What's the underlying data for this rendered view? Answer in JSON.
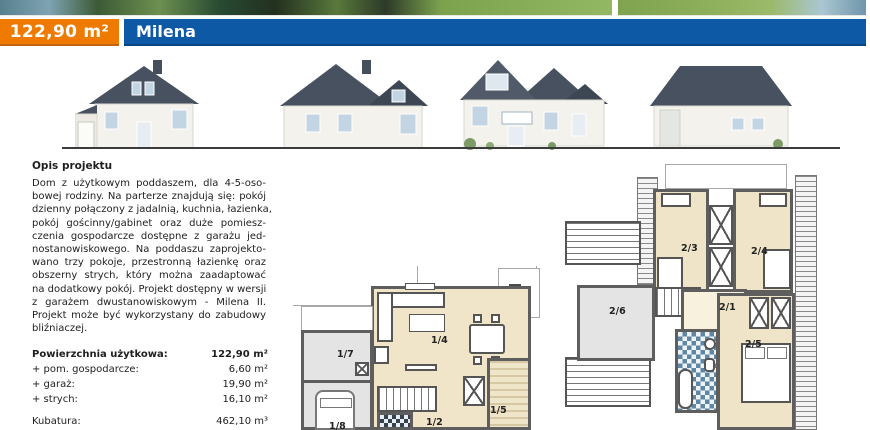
{
  "header": {
    "area_label": "122,90 m²",
    "project_name": "Milena",
    "accent_orange": "#ee7b00",
    "accent_blue": "#0e59a6"
  },
  "photo_strip": {
    "left_photo": "lake-and-garden-photo",
    "right_photo": "garden-lawn-photo"
  },
  "description": {
    "heading": "Opis projektu",
    "lines": [
      "Dom z użytkowym poddaszem, dla 4-5-oso-",
      "bowej rodziny. Na parterze znajdują się: pokój",
      "dzienny połączony z jadalnią, kuchnia, łazienka,",
      "pokój gościnny/gabinet oraz duże pomiesz-",
      "czenia gospodarcze dostępne z garażu jed-",
      "nostanowiskowego. Na poddaszu zaprojekto-",
      "wano trzy pokoje, przestronną łazienkę oraz",
      "obszerny strych, który można zaadaptować",
      "na dodatkowy pokój. Projekt dostępny w wersji",
      "z garażem dwustanowiskowym - Milena II.",
      "Projekt może być wykorzystany do zabudowy",
      "bliźniaczej."
    ]
  },
  "specs": {
    "rows": [
      {
        "label": "Powierzchnia użytkowa:",
        "value": "122,90 m²",
        "strong": true
      },
      {
        "label": "+ pom. gospodarcze:",
        "value": "6,60 m²"
      },
      {
        "label": "+ garaż:",
        "value": "19,90 m²"
      },
      {
        "label": "+ strych:",
        "value": "16,10 m²"
      },
      {
        "label": "",
        "value": "",
        "spacer": true
      },
      {
        "label": "Kubatura:",
        "value": "462,10 m³"
      },
      {
        "label": "Wymiary budynku:",
        "value": "10,00 m x 11,00 m"
      }
    ]
  },
  "plans": {
    "ground": {
      "rooms": {
        "r17": "1/7",
        "r14": "1/4",
        "r12": "1/2",
        "r15": "1/5",
        "r18": "1/8"
      }
    },
    "upper": {
      "rooms": {
        "r21": "2/1",
        "r23": "2/3",
        "r24": "2/4",
        "r25": "2/5",
        "r26": "2/6"
      }
    }
  }
}
